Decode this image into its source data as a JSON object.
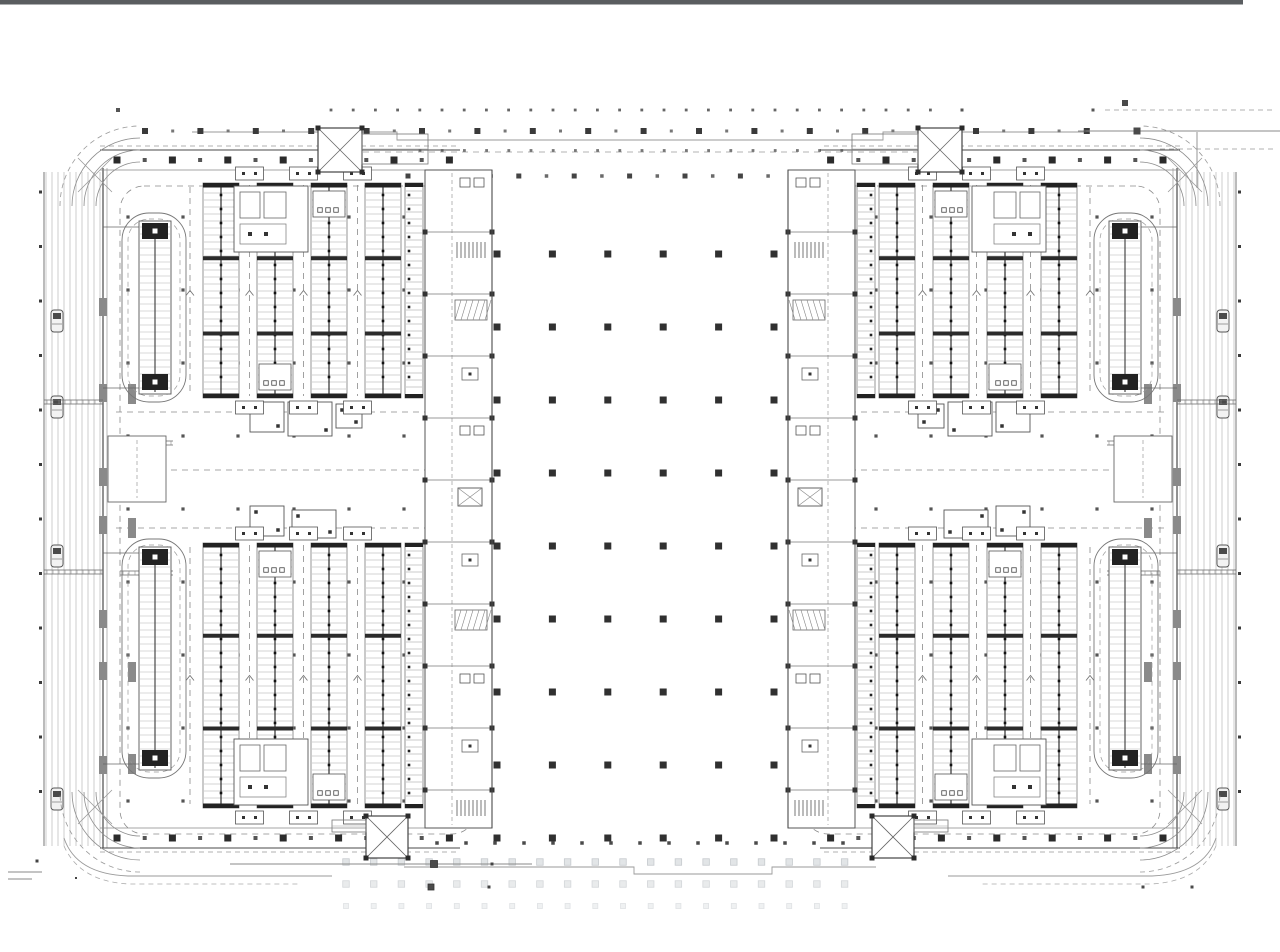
{
  "meta": {
    "drawing_type": "architectural-floor-plan",
    "canvas": {
      "w": 1280,
      "h": 952
    }
  },
  "palette": {
    "paper": "#ffffff",
    "topbar": "#5a5d60",
    "ink": "#2f2f2f",
    "dark": "#1e1e1e",
    "wall": "#4a4a4a",
    "mid": "#6e6e6e",
    "light": "#9a9a9a",
    "faintline": "#b8b8b8",
    "rung": "#a8a8a8",
    "pier": "#8a8a8a",
    "fade1f": "#e2e5e7",
    "fade1s": "#c6cace",
    "fade2f": "#e9ebec",
    "fade2s": "#d3d6d9",
    "fade3f": "#eff1f2",
    "fade3s": "#dfe2e4"
  },
  "topbar": {
    "x": 0,
    "y": 0,
    "w": 1243,
    "h": 4.5
  },
  "dot_fields": {
    "row_a": {
      "y": 110,
      "x0": 331,
      "x1": 950,
      "step": 22.2,
      "size": 2.8
    },
    "row_a_extra": [
      [
        118,
        110,
        4
      ],
      [
        962,
        110,
        3
      ]
    ],
    "row_b": {
      "y": 131,
      "x0": 145,
      "x1": 1090,
      "step": 55.4,
      "big": 6,
      "small": 3
    },
    "row_c": {
      "y": 150.5,
      "x0": 420,
      "x1": 862,
      "step": 22.2,
      "size": 2.8
    },
    "row_d": {
      "y": 176,
      "x0": 408,
      "x1": 872,
      "step": 27.7,
      "a": 5,
      "b": 3.5
    },
    "center_grid": {
      "x0": 497,
      "xstep": 55.4,
      "nx": 6,
      "y0": 254,
      "ystep": 73,
      "ny": 9,
      "size": 7
    },
    "dark_bottom_row": {
      "y": 843,
      "x0": 437,
      "x1": 845,
      "step": 29,
      "size": 3.5
    },
    "faded": {
      "x0": 346,
      "x1": 861,
      "step": 27.7,
      "rows": [
        {
          "y": 862,
          "s": 6.5,
          "f": "fade1f",
          "st": "fade1s"
        },
        {
          "y": 884,
          "s": 6.5,
          "f": "fade2f",
          "st": "fade2s"
        },
        {
          "y": 906,
          "s": 5,
          "f": "fade3f",
          "st": "fade3s"
        }
      ]
    }
  },
  "center_lines": {
    "boundary_top": "M192 132 H397 V140 H883 V132 H1088",
    "boundary_bottom": "M404 867 H634 V874 H772 V867 H876",
    "link_dash_top": {
      "y": 152,
      "x0": 363,
      "x1": 917
    }
  },
  "marks": {
    "bottom_left": {
      "lines": [
        [
          8,
          872,
          42,
          872
        ],
        [
          8,
          879,
          32,
          879
        ],
        [
          230,
          864,
          532,
          864
        ]
      ],
      "dots": [
        [
          37,
          861,
          3
        ],
        [
          76,
          878,
          2
        ],
        [
          492,
          864,
          3
        ],
        [
          489,
          887,
          3
        ]
      ],
      "squares": [
        [
          434,
          864,
          7
        ],
        [
          431,
          887,
          6
        ]
      ]
    },
    "top_right": {
      "dash_lines": [
        [
          1105,
          110,
          1272,
          110
        ],
        [
          1160,
          149,
          1275,
          149
        ]
      ],
      "lines": [
        [
          1078,
          131,
          1280,
          131
        ],
        [
          1197,
          132,
          1197,
          188
        ]
      ],
      "squares": [
        [
          1125,
          103,
          6
        ],
        [
          1137,
          131,
          7
        ]
      ],
      "dots": [
        [
          1093,
          110,
          3
        ],
        [
          1085,
          131,
          2.5
        ]
      ]
    },
    "bottom_right_dots": [
      [
        1143,
        887,
        3
      ],
      [
        1192,
        887,
        3
      ]
    ]
  },
  "wing": {
    "stripes": {
      "x0": 46,
      "n": 10,
      "step": 6,
      "y0": 172,
      "y1": 846
    },
    "edge_line_x": 44,
    "edge_ticks": {
      "x": 40.5,
      "y0": 192,
      "y1": 840,
      "step": 54.5,
      "size": 3
    },
    "cars": {
      "x": 51,
      "w": 12,
      "h": 22,
      "ys": [
        310,
        396,
        545,
        788
      ]
    },
    "wall": {
      "x1": 103,
      "x2": 107,
      "y0": 168,
      "y1": 848
    },
    "wall_piers": {
      "x": 99,
      "w": 8,
      "h": 18,
      "ys": [
        298,
        384,
        468,
        516,
        610,
        662,
        756
      ]
    },
    "outer_ties": {
      "x0": 44,
      "x1": 103,
      "ys": [
        400,
        570
      ]
    },
    "inner_ties": {
      "x0": 120,
      "x1": 173,
      "ys": [
        441,
        571
      ]
    },
    "top_band": {
      "y_out": 150,
      "y_in": 170,
      "x0": 100,
      "x1": 460,
      "col_y": 160,
      "dash_y": 146
    },
    "bottom_band": {
      "y_out": 848,
      "y_in": 828,
      "x0": 100,
      "x1": 460,
      "col_y": 838,
      "dash_y": 852
    },
    "band_cols": {
      "x0": 117,
      "step": 55.4,
      "n": 7,
      "big": 7,
      "small": 4
    },
    "stair_top": {
      "x": 318,
      "y": 128,
      "s": 44,
      "ext": [
        362,
        134,
        66,
        30
      ]
    },
    "stair_bottom": {
      "x": 366,
      "y": 816,
      "s": 42,
      "ext": [
        332,
        820,
        34,
        12
      ]
    },
    "inner_band": {
      "x0": 425,
      "x1": 492,
      "y0": 170,
      "y1": 828,
      "dash_x": 452,
      "rows": [
        232,
        294,
        356,
        418,
        480,
        542,
        604,
        666,
        728,
        790
      ],
      "pattern": [
        "boxes",
        "grille",
        "hatch",
        "mini",
        "boxes",
        "lift",
        "mini",
        "hatch",
        "boxes",
        "mini",
        "grille"
      ]
    },
    "inner_wall": {
      "x": 492,
      "y0": 170,
      "y1": 828
    },
    "perimeter_dash": {
      "x0": 120,
      "y0": 186,
      "x1": 476,
      "y1": 834,
      "r": 24
    },
    "midzone": {
      "lanes": [
        412,
        470,
        528
      ],
      "lane_x0": 116,
      "lane_x1": 490,
      "rooms": [
        [
          250,
          402,
          34,
          30
        ],
        [
          288,
          402,
          44,
          34
        ],
        [
          336,
          404,
          26,
          24
        ],
        [
          250,
          506,
          34,
          30
        ],
        [
          292,
          510,
          44,
          28
        ]
      ],
      "bigroom": [
        108,
        436,
        58,
        66
      ],
      "piers": [
        [
          128,
          384
        ],
        [
          128,
          518
        ],
        [
          128,
          662
        ],
        [
          128,
          754
        ]
      ]
    },
    "interior_dots": {
      "xs": [
        128,
        183,
        238,
        294,
        349,
        404
      ],
      "ys": [
        217,
        290,
        363,
        436,
        509,
        582,
        655,
        728,
        801
      ],
      "size": 3.2
    },
    "block_geo": {
      "bands_x": [
        203,
        257,
        311,
        365
      ],
      "band_w": 36,
      "single_x": 405,
      "single_w": 18,
      "aisles": [
        249.5,
        303.5,
        357.5
      ],
      "left_aisle": 190,
      "rt_x0": 122,
      "rt_x1": 186,
      "rack_x0": 139,
      "rack_x1": 171
    },
    "blocks": [
      {
        "y0": 183,
        "y1": 398,
        "rt_y0": 213,
        "rt_y1": 402,
        "eq_room": "top"
      },
      {
        "y0": 543,
        "y1": 808,
        "rt_y0": 539,
        "rt_y1": 778,
        "eq_room": "bottom"
      }
    ],
    "corners": {
      "tl": {
        "cx": 140,
        "cy": 206
      },
      "bl": {
        "cx": 140,
        "cy": 792
      },
      "radii": [
        44,
        56,
        68
      ],
      "dash_r": 80,
      "tl_cross": [
        [
          78,
          158,
          112,
          192
        ],
        [
          112,
          158,
          78,
          192
        ]
      ],
      "bl_cross": [
        [
          78,
          790,
          112,
          824
        ],
        [
          112,
          790,
          78,
          824
        ]
      ],
      "bl_tail_solid": "M 64 838 Q 76 874 128 876 H 332",
      "bl_tail_dash": "M 64 846 Q 80 882 130 884 H 300"
    }
  }
}
